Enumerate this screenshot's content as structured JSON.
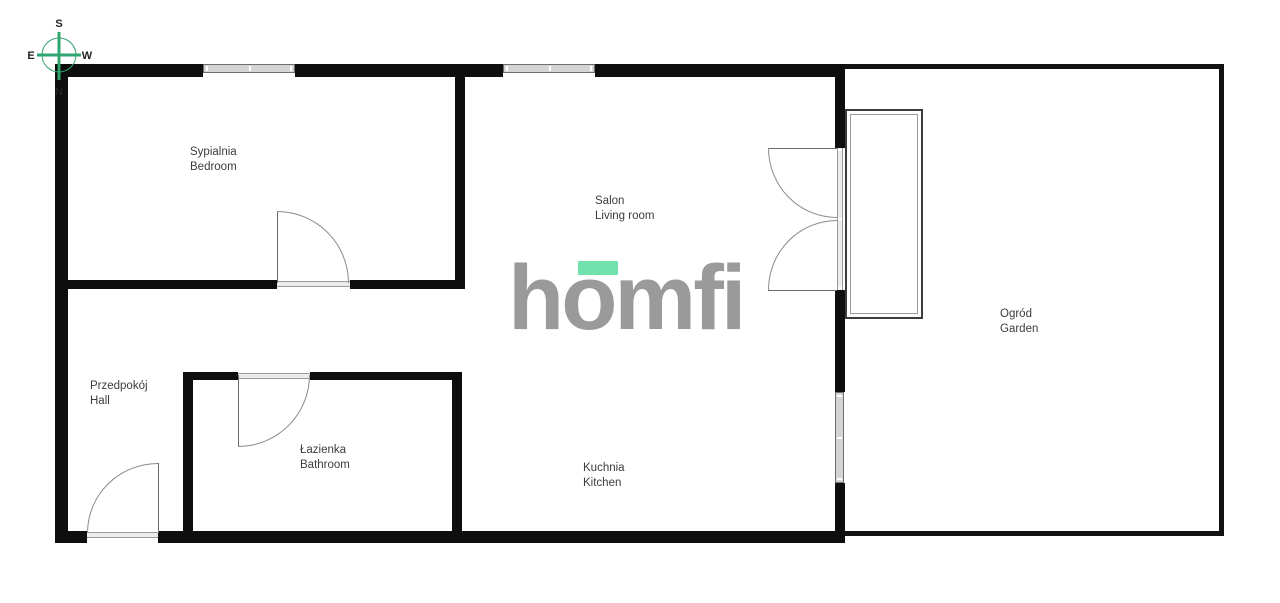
{
  "compass": {
    "top": "S",
    "bottom": "N",
    "left": "E",
    "right": "W"
  },
  "logo": {
    "text": "homfi",
    "letter_color": "#9a9a9a",
    "accent_color": "#70e1aa"
  },
  "rooms": [
    {
      "name_pl": "Sypialnia",
      "name_en": "Bedroom"
    },
    {
      "name_pl": "Salon",
      "name_en": "Living room"
    },
    {
      "name_pl": "Przedpokój",
      "name_en": "Hall"
    },
    {
      "name_pl": "Łazienka",
      "name_en": "Bathroom"
    },
    {
      "name_pl": "Kuchnia",
      "name_en": "Kitchen"
    },
    {
      "name_pl": "Ogród",
      "name_en": "Garden"
    }
  ],
  "colors": {
    "wall": "#0e0e0e",
    "door_line": "#8a8a8a",
    "window_fill": "#d4d4d4",
    "compass_green": "#2fa56f",
    "label_text": "#3c3c3c"
  }
}
